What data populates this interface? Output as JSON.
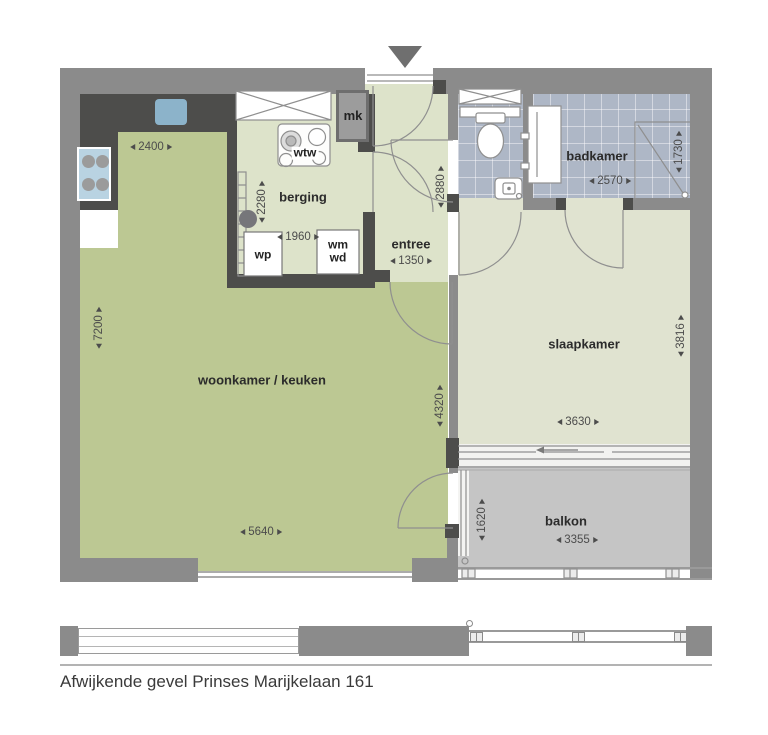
{
  "caption": "Afwijkende gevel Prinses Marijkelaan 161",
  "rooms": {
    "woonkamer": {
      "label": "woonkamer / keuken",
      "dim_left": "7200",
      "dim_right": "4320",
      "dim_bottom": "5640",
      "dim_kitchen": "2400"
    },
    "berging": {
      "label": "berging",
      "dim_v": "2280",
      "dim_h": "1960"
    },
    "entree": {
      "label": "entree",
      "dim_v": "2880",
      "dim_h": "1350"
    },
    "badkamer": {
      "label": "badkamer",
      "dim_h": "2570",
      "dim_shower": "1730"
    },
    "slaapkamer": {
      "label": "slaapkamer",
      "dim_v": "3816",
      "dim_h": "3630"
    },
    "balkon": {
      "label": "balkon",
      "dim_v": "1620",
      "dim_h": "3355"
    }
  },
  "fixtures": {
    "mk": "mk",
    "wtw": "wtw",
    "wp": "wp",
    "wm": "wm",
    "wd": "wd"
  },
  "colors": {
    "wall": "#8b8b8b",
    "wall_dark": "#4d4d4b",
    "living_green": "#bcc893",
    "pale_green": "#dde3ca",
    "bedroom_green": "#e0e3d0",
    "bath_tile": "#aeb7c6",
    "balcony_gray": "#c5c5c5",
    "sink_blue": "#8cb3ca",
    "stove_blue": "#b9d3e2",
    "annotation_text": "#4c4c4c"
  }
}
